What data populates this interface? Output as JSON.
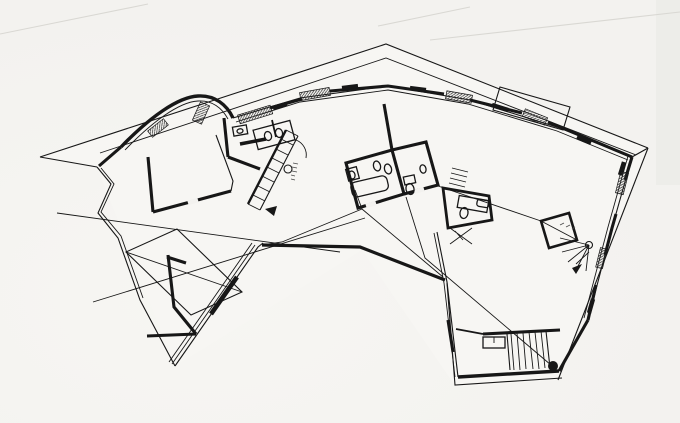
{
  "meta": {
    "title": "Architectural floor plan — black ink line drawing of an angled two-wing house",
    "drawing_type": "floor-plan",
    "style": "hand-drafted black ink on white paper, no legible text labels",
    "annotations_note": "two tiny handwritten stair notations are present but illegible at this resolution"
  },
  "colors": {
    "paper": "#f3f2ef",
    "ink": "#171717",
    "faint": "#d9d8d3"
  },
  "features": [
    "roof-outline",
    "curved-north-wall",
    "zigzag-terrace-edge-west",
    "central-staircase-with-newel-circle",
    "twin-washbasin-counter",
    "wall-hung-wc",
    "bathroom-with-bathtub-and-two-wcs",
    "small-wc-room-east",
    "winder-staircase-with-fan-treads",
    "entrance-staircase-bottom-right",
    "round-column-black-dot",
    "glazed-window-bands-with-hatching",
    "roof-valley-lines",
    "dormer-rectangle-top-right"
  ]
}
